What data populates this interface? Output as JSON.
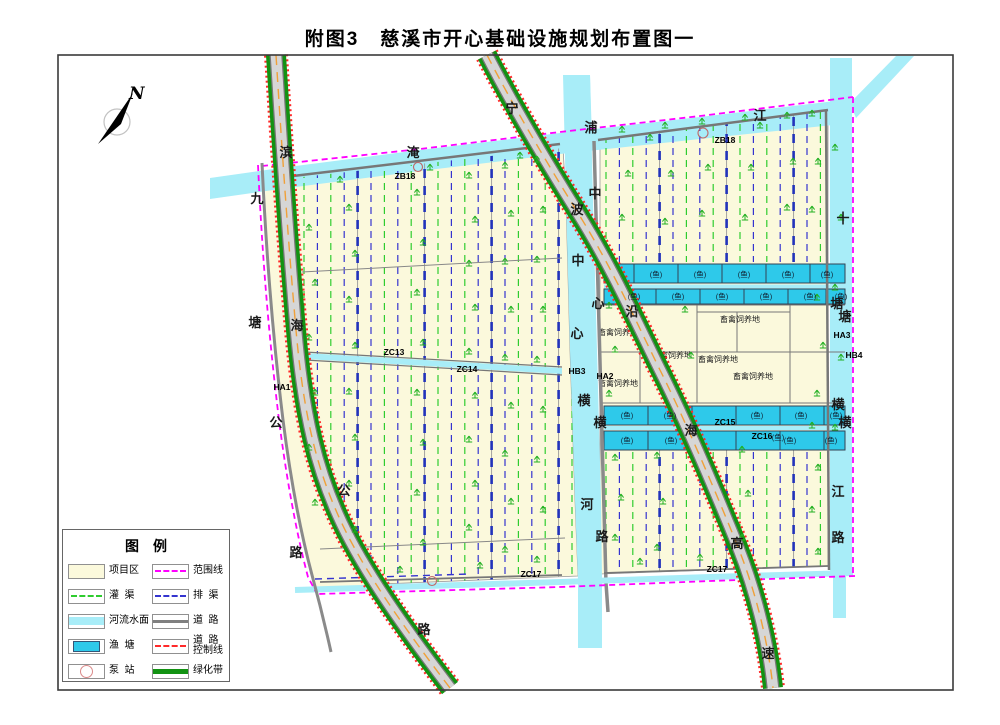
{
  "title": "附图3　慈溪市开心基础设施规划布置图一",
  "north": {
    "label": "N"
  },
  "legend": {
    "title": "图例",
    "items": [
      {
        "id": "project-area",
        "label": "项目区",
        "swatch": "area-cream"
      },
      {
        "id": "boundary-line",
        "label": "范围线",
        "swatch": "dash-magenta"
      },
      {
        "id": "irrigation-channel",
        "label": "灌  渠",
        "swatch": "dash-green"
      },
      {
        "id": "drainage-channel",
        "label": "排  渠",
        "swatch": "dash-blue"
      },
      {
        "id": "river-surface",
        "label": "河流水面",
        "swatch": "area-cyan"
      },
      {
        "id": "road",
        "label": "道  路",
        "swatch": "line-gray"
      },
      {
        "id": "fish-pond",
        "label": "渔  塘",
        "swatch": "pond"
      },
      {
        "id": "road-control-line",
        "label": "道  路",
        "label2": "控制线",
        "swatch": "dash-red"
      },
      {
        "id": "pump-station",
        "label": "泵  站",
        "swatch": "pump"
      },
      {
        "id": "green-belt",
        "label": "绿化带",
        "swatch": "line-green"
      }
    ]
  },
  "colors": {
    "cream": "#FBF9DC",
    "river": "#A8EDF8",
    "pond": "#2EC9EA",
    "green_belt": "#129212",
    "magenta": "#FF00FF",
    "red_control": "#FF2A2A",
    "orange_centerline": "#F0A038",
    "road_fill": "#D6D6D6",
    "dash_green": "#2FCC2F",
    "dash_blue": "#3434CF",
    "frame": "#3A3A3A"
  },
  "map": {
    "road_names": [
      {
        "name": "binhai-highway",
        "chars": [
          [
            "滨",
            286,
            157
          ],
          [
            "海",
            297,
            330
          ],
          [
            "公",
            344,
            495
          ],
          [
            "路",
            424,
            634
          ]
        ]
      },
      {
        "name": "jiutang-road",
        "chars": [
          [
            "九",
            257,
            203
          ],
          [
            "塘",
            255,
            327
          ],
          [
            "公",
            276,
            427
          ],
          [
            "路",
            296,
            557
          ]
        ]
      },
      {
        "name": "yanhai-expressway",
        "chars": [
          [
            "宁",
            512,
            113
          ],
          [
            "波",
            577,
            214
          ],
          [
            "沿",
            632,
            316
          ],
          [
            "海",
            691,
            435
          ],
          [
            "高",
            737,
            548
          ],
          [
            "速",
            768,
            658
          ]
        ]
      },
      {
        "name": "yanpu-river",
        "chars": [
          [
            "淹",
            413,
            157
          ],
          [
            "浦",
            591,
            132
          ],
          [
            "江",
            760,
            120
          ]
        ]
      },
      {
        "name": "central-river",
        "chars": [
          [
            "中",
            578,
            265
          ],
          [
            "心",
            577,
            338
          ],
          [
            "横",
            584,
            405
          ],
          [
            "河",
            587,
            509
          ]
        ]
      },
      {
        "name": "central-road",
        "chars": [
          [
            "中",
            595,
            198
          ],
          [
            "心",
            598,
            308
          ],
          [
            "横",
            600,
            427
          ],
          [
            "路",
            602,
            541
          ]
        ]
      },
      {
        "name": "shitang-river",
        "chars": [
          [
            "十",
            843,
            223
          ],
          [
            "塘",
            837,
            308
          ],
          [
            "塘",
            845,
            321
          ],
          [
            "横",
            838,
            409
          ],
          [
            "横",
            845,
            427
          ],
          [
            "江",
            838,
            496
          ],
          [
            "路",
            838,
            542
          ]
        ]
      }
    ],
    "id_labels": [
      [
        "ZB18",
        405,
        179
      ],
      [
        "ZB18",
        725,
        143
      ],
      [
        "ZC13",
        394,
        355
      ],
      [
        "ZC14",
        467,
        372
      ],
      [
        "ZC15",
        725,
        425
      ],
      [
        "ZC16",
        762,
        439
      ],
      [
        "ZC17",
        531,
        577
      ],
      [
        "ZC17",
        717,
        572
      ],
      [
        "HA1",
        282,
        390
      ],
      [
        "HB3",
        577,
        374
      ],
      [
        "HA2",
        605,
        379
      ],
      [
        "HA3",
        842,
        338
      ],
      [
        "HB4",
        854,
        358
      ]
    ],
    "area_label": "畜禽饲养地",
    "area_label_positions": [
      [
        618,
        335
      ],
      [
        740,
        322
      ],
      [
        672,
        358
      ],
      [
        718,
        362
      ],
      [
        753,
        379
      ],
      [
        618,
        386
      ]
    ],
    "pond_label": "(鱼)",
    "pond_label_positions": [
      [
        656,
        277
      ],
      [
        700,
        277
      ],
      [
        744,
        277
      ],
      [
        788,
        277
      ],
      [
        827,
        277
      ],
      [
        634,
        299
      ],
      [
        678,
        299
      ],
      [
        722,
        299
      ],
      [
        766,
        299
      ],
      [
        810,
        299
      ],
      [
        841,
        299
      ],
      [
        627,
        418
      ],
      [
        670,
        418
      ],
      [
        757,
        418
      ],
      [
        801,
        418
      ],
      [
        836,
        418
      ],
      [
        627,
        443
      ],
      [
        671,
        443
      ],
      [
        778,
        440
      ],
      [
        790,
        443
      ],
      [
        831,
        443
      ]
    ]
  }
}
